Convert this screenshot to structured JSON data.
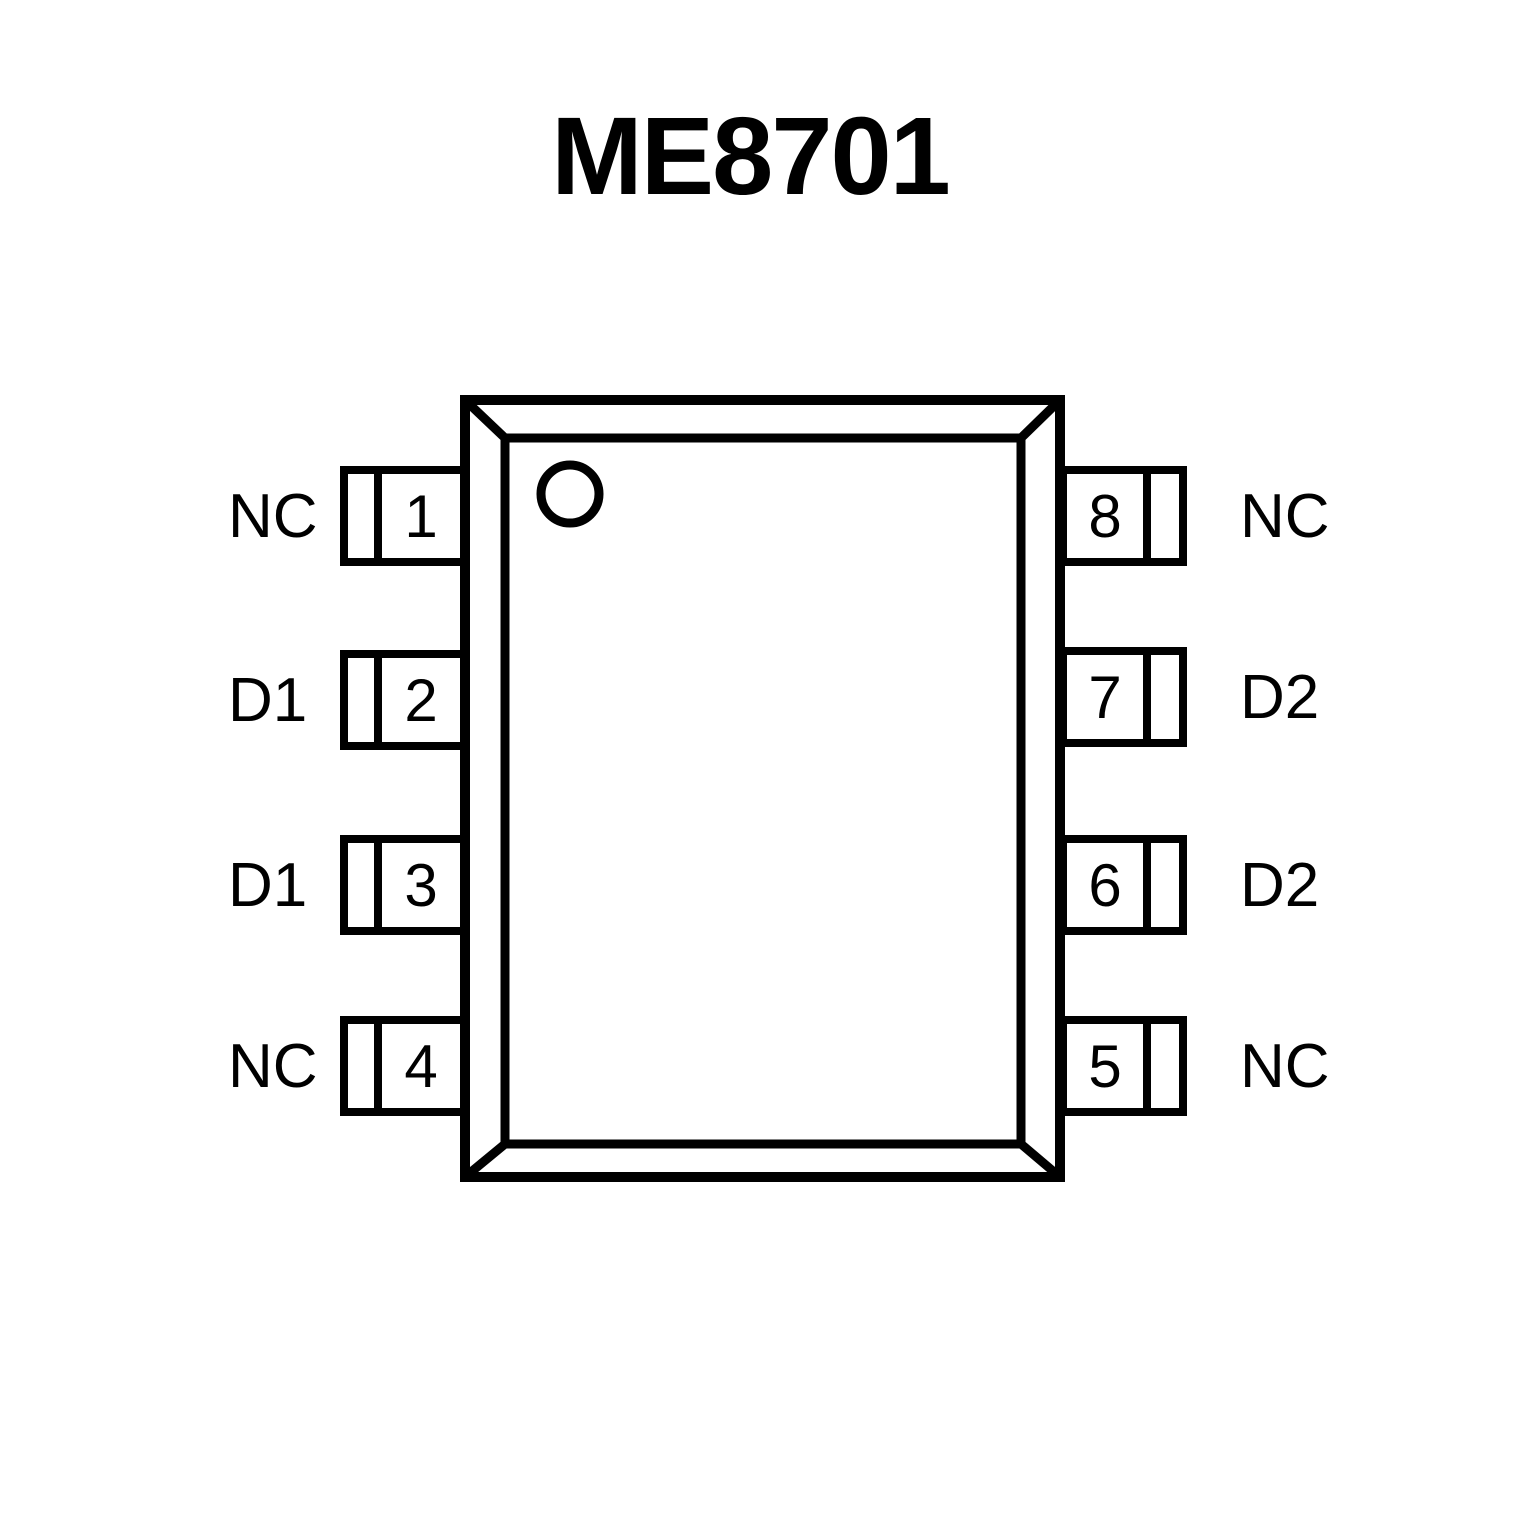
{
  "title": "ME8701",
  "colors": {
    "line": "#000000",
    "background": "#ffffff"
  },
  "chip": {
    "package_style": "8-pin dual-in-line top view",
    "pin1_indicator": "circle-top-left"
  },
  "pins": {
    "left": [
      {
        "number": "1",
        "label": "NC"
      },
      {
        "number": "2",
        "label": "D1"
      },
      {
        "number": "3",
        "label": "D1"
      },
      {
        "number": "4",
        "label": "NC"
      }
    ],
    "right": [
      {
        "number": "8",
        "label": "NC"
      },
      {
        "number": "7",
        "label": "D2"
      },
      {
        "number": "6",
        "label": "D2"
      },
      {
        "number": "5",
        "label": "NC"
      }
    ]
  }
}
